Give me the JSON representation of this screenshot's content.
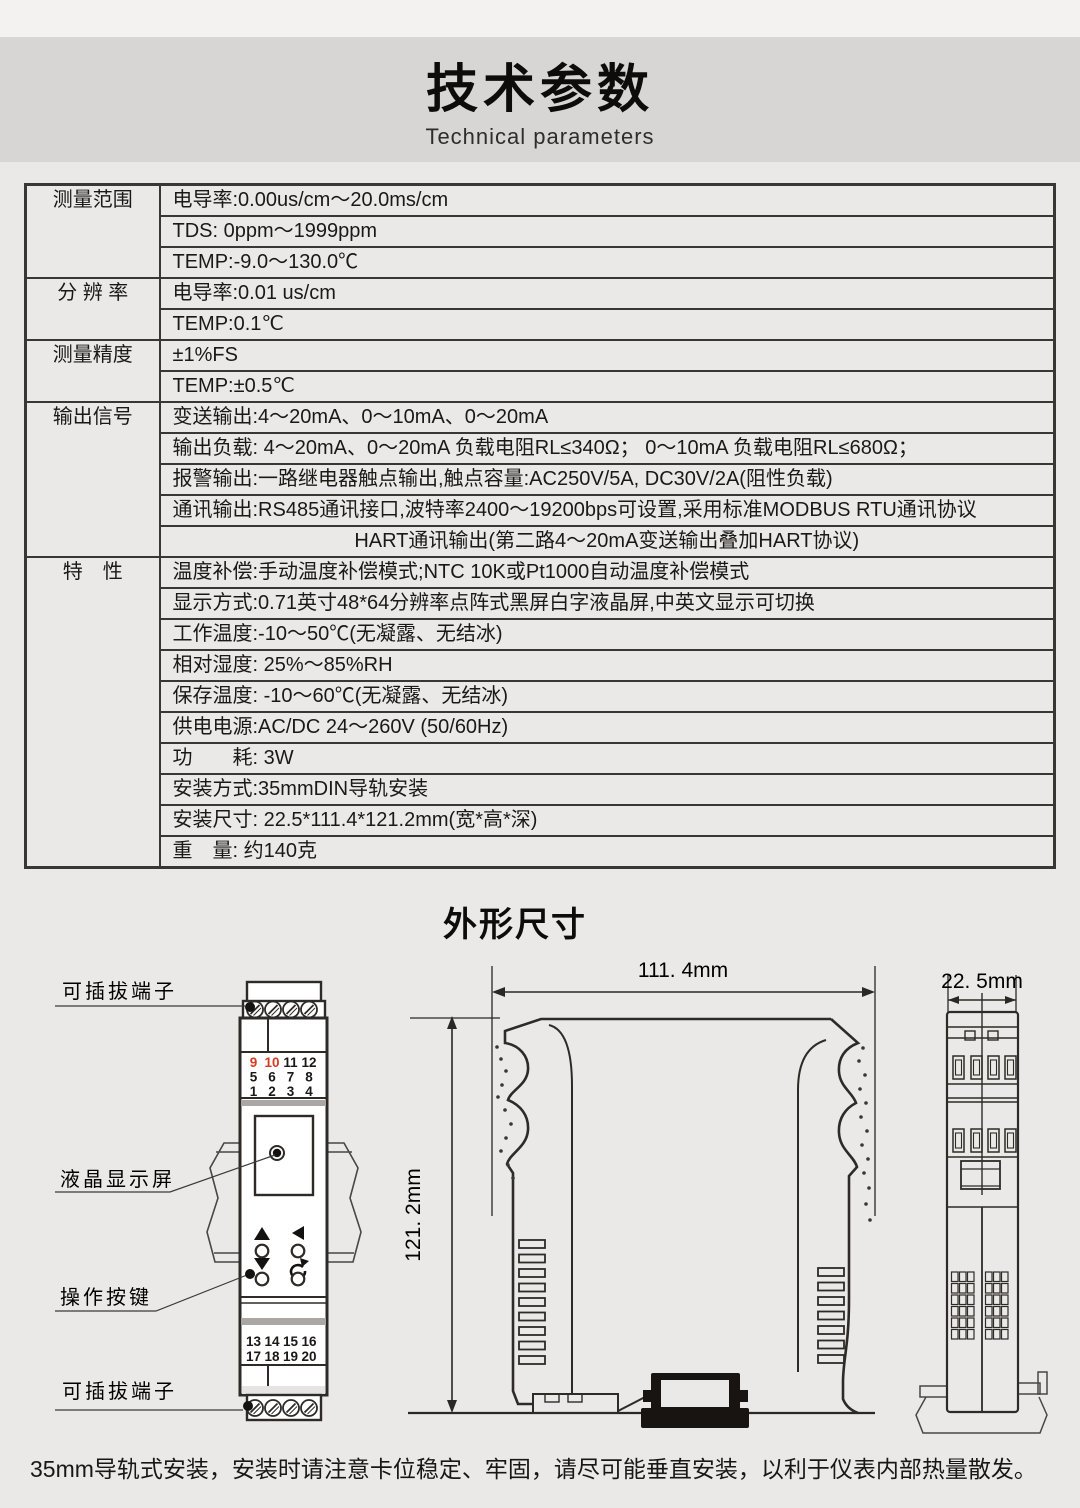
{
  "page": {
    "title": "技术参数",
    "subtitle": "Technical parameters",
    "footer_note": "35mm导轨式安装，安装时请注意卡位稳定、牢固，请尽可能垂直安装，以利于仪表内部热量散发。"
  },
  "spec_table": {
    "groups": [
      {
        "label": "测量范围",
        "rows": [
          {
            "text": "电导率:0.00us/cm～20.0ms/cm"
          },
          {
            "text": "TDS: 0ppm～1999ppm"
          },
          {
            "text": "TEMP:-9.0～130.0℃"
          }
        ]
      },
      {
        "label": "分 辨 率",
        "rows": [
          {
            "text": "电导率:0.01 us/cm"
          },
          {
            "text": "TEMP:0.1℃"
          }
        ]
      },
      {
        "label": "测量精度",
        "rows": [
          {
            "text": "±1%FS"
          },
          {
            "text": "TEMP:±0.5℃"
          }
        ]
      },
      {
        "label": "输出信号",
        "rows": [
          {
            "text": "变送输出:4～20mA、0～10mA、0～20mA"
          },
          {
            "text": "输出负载: 4～20mA、0～20mA 负载电阻RL≤340Ω； 0～10mA 负载电阻RL≤680Ω；"
          },
          {
            "text": "报警输出:一路继电器触点输出,触点容量:AC250V/5A, DC30V/2A(阻性负载)"
          },
          {
            "text": "通讯输出:RS485通讯接口,波特率2400～19200bps可设置,采用标准MODBUS RTU通讯协议"
          },
          {
            "text": "HART通讯输出(第二路4～20mA变送输出叠加HART协议)",
            "align": "center"
          }
        ]
      },
      {
        "label": "特　性",
        "rows": [
          {
            "text": "温度补偿:手动温度补偿模式;NTC 10K或Pt1000自动温度补偿模式"
          },
          {
            "text": "显示方式:0.71英寸48*64分辨率点阵式黑屏白字液晶屏,中英文显示可切换"
          },
          {
            "text": "工作温度:-10～50℃(无凝露、无结冰)"
          },
          {
            "text": "相对湿度: 25%～85%RH"
          },
          {
            "text": "保存温度: -10～60℃(无凝露、无结冰)"
          },
          {
            "text": "供电电源:AC/DC 24～260V (50/60Hz)"
          },
          {
            "text": "功　　耗: 3W"
          },
          {
            "text": "安装方式:35mmDIN导轨安装"
          },
          {
            "text": "安装尺寸: 22.5*111.4*121.2mm(宽*高*深)"
          },
          {
            "text": "重　量: 约140克"
          }
        ]
      }
    ]
  },
  "dimensions": {
    "section_title": "外形尺寸",
    "callouts": {
      "top_terminal": "可插拔端子",
      "lcd": "液晶显示屏",
      "keys": "操作按键",
      "bottom_terminal": "可插拔端子"
    },
    "width_label": "111. 4mm",
    "height_label": "121. 2mm",
    "depth_label": "22. 5mm",
    "terminals": {
      "top_rows": [
        [
          "9",
          "10",
          "11",
          "12"
        ],
        [
          "5",
          "6",
          "7",
          "8"
        ],
        [
          "1",
          "2",
          "3",
          "4"
        ]
      ],
      "bottom_rows": [
        [
          "13",
          "14",
          "15",
          "16"
        ],
        [
          "17",
          "18",
          "19",
          "20"
        ]
      ],
      "red_numbers": [
        "9",
        "10"
      ]
    }
  },
  "colors": {
    "accent_red": "#d43b20",
    "line_dark": "#2e2a27",
    "title_band": "#d8d6d4",
    "page_bg": "#ebe9e7"
  }
}
